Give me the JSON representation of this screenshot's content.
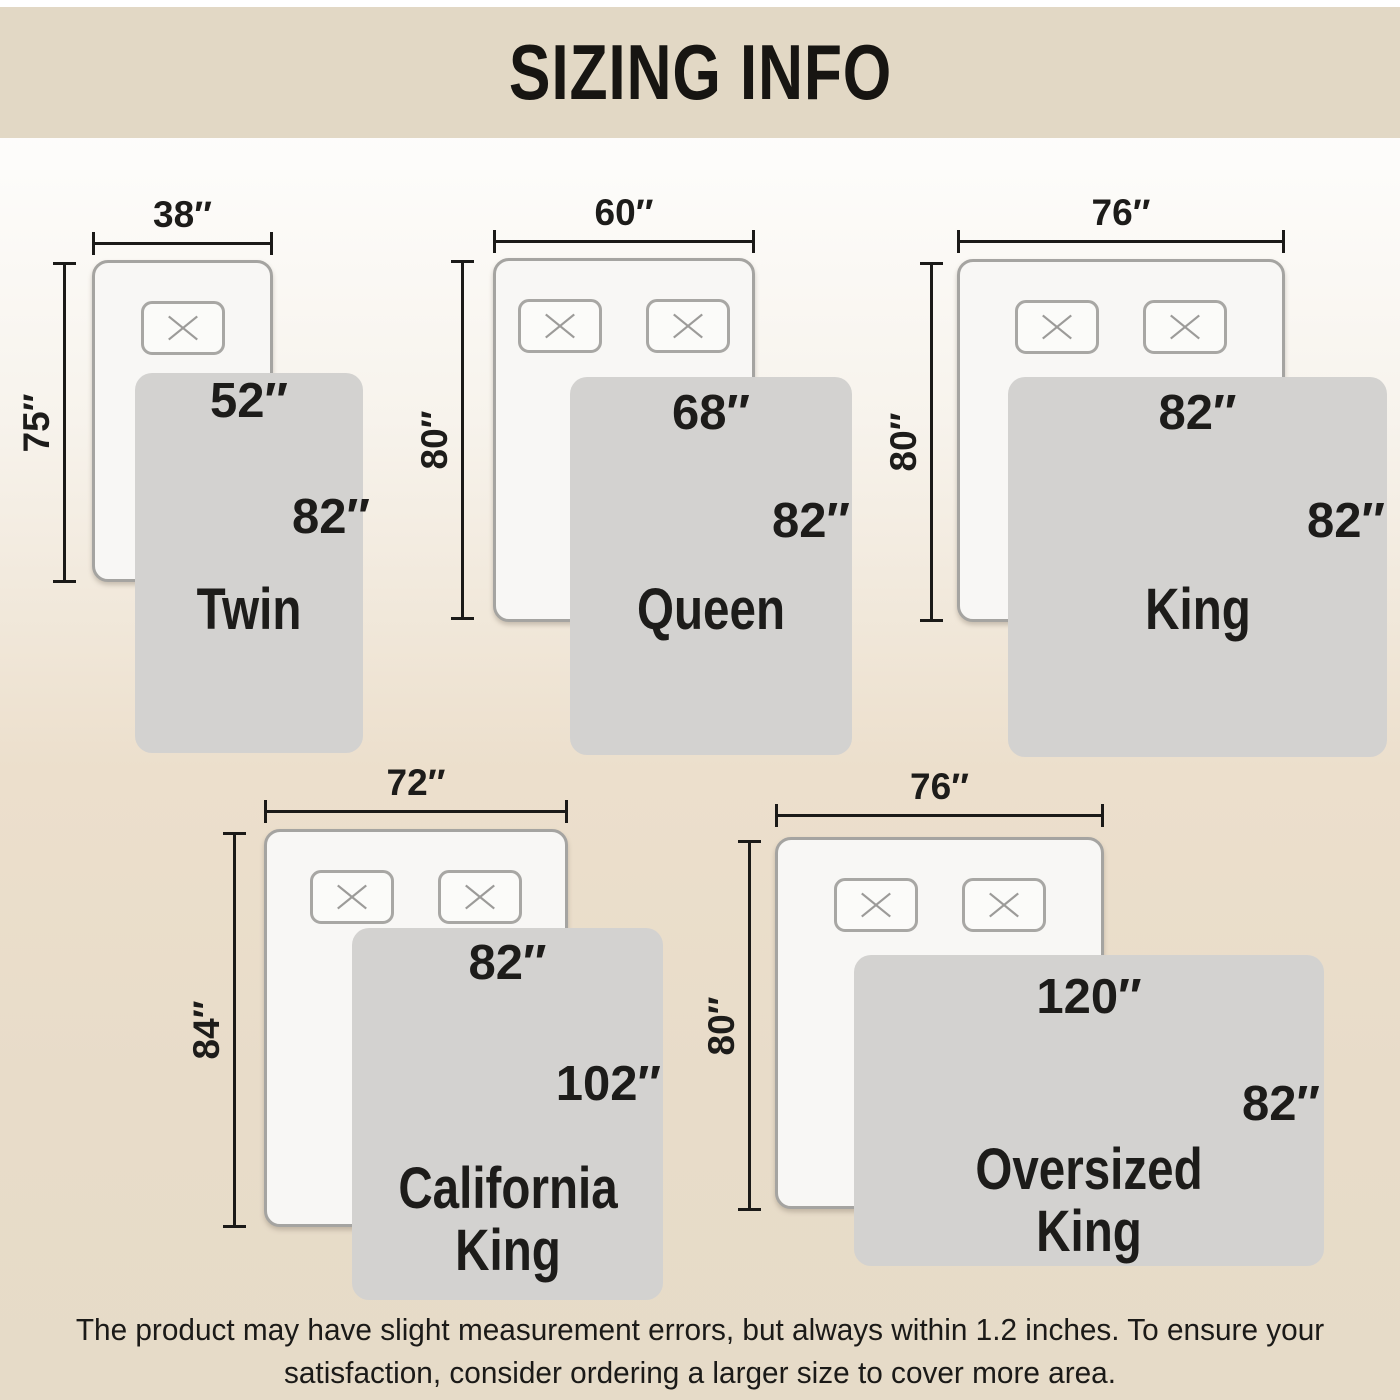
{
  "banner": {
    "title": "SIZING INFO"
  },
  "footer": {
    "lines": [
      "The product may have slight measurement errors, but always within 1.2 inches. To ensure your",
      "satisfaction, consider ordering a larger size to cover more area."
    ]
  },
  "colors": {
    "banner_bg": "#e2d8c5",
    "bg_top": "#ffffff",
    "bg_bottom": "#e6dbc8",
    "line": "#1b1a18",
    "mattress_fill": "#f8f7f5",
    "mattress_border": "#a5a4a1",
    "pillow_fill": "#fbfbf9",
    "pillow_border": "#a8a7a4",
    "pillow_x": "#9c9b99",
    "blanket_fill": "#d3d2d0",
    "text": "#1d1c1a"
  },
  "diagrams": [
    {
      "id": "twin",
      "name_lines": [
        "Twin"
      ],
      "mattress_width": "38″",
      "mattress_length": "75″",
      "blanket_width": "52″",
      "blanket_length": "82″",
      "pillows": 1,
      "geometry": {
        "mattress": {
          "x": 92,
          "y": 260,
          "w": 181,
          "h": 322
        },
        "dim_top_y": 242,
        "dim_left": {
          "x": 63,
          "y": 262,
          "h": 321
        },
        "blanket": {
          "x": 135,
          "y": 373,
          "w": 228,
          "h": 380
        },
        "w_label_top": 0,
        "h_label_pct": 38,
        "h_label_right": -7,
        "name_center_y": 237
      }
    },
    {
      "id": "queen",
      "name_lines": [
        "Queen"
      ],
      "mattress_width": "60″",
      "mattress_length": "80″",
      "blanket_width": "68″",
      "blanket_length": "82″",
      "pillows": 2,
      "geometry": {
        "mattress": {
          "x": 493,
          "y": 258,
          "w": 262,
          "h": 364
        },
        "dim_top_y": 240,
        "dim_left": {
          "x": 461,
          "y": 260,
          "h": 360
        },
        "blanket": {
          "x": 570,
          "y": 377,
          "w": 282,
          "h": 378
        },
        "w_label_top": 8,
        "h_label_pct": 38,
        "h_label_right": 2,
        "name_center_y": 233
      }
    },
    {
      "id": "king",
      "name_lines": [
        "King"
      ],
      "mattress_width": "76″",
      "mattress_length": "80″",
      "blanket_width": "82″",
      "blanket_length": "82″",
      "pillows": 2,
      "geometry": {
        "mattress": {
          "x": 957,
          "y": 259,
          "w": 328,
          "h": 363
        },
        "dim_top_y": 240,
        "dim_left": {
          "x": 930,
          "y": 262,
          "h": 360
        },
        "blanket": {
          "x": 1008,
          "y": 377,
          "w": 379,
          "h": 380
        },
        "w_label_top": 8,
        "h_label_pct": 38,
        "h_label_right": 2,
        "name_center_y": 233
      }
    },
    {
      "id": "california-king",
      "name_lines": [
        "California",
        "King"
      ],
      "mattress_width": "72″",
      "mattress_length": "84″",
      "blanket_width": "82″",
      "blanket_length": "102″",
      "pillows": 2,
      "geometry": {
        "mattress": {
          "x": 264,
          "y": 829,
          "w": 304,
          "h": 398
        },
        "dim_top_y": 810,
        "dim_left": {
          "x": 233,
          "y": 832,
          "h": 396
        },
        "blanket": {
          "x": 352,
          "y": 928,
          "w": 311,
          "h": 372
        },
        "w_label_top": 7,
        "h_label_pct": 42,
        "h_label_right": 2,
        "name_center_y": 292
      }
    },
    {
      "id": "oversized-king",
      "name_lines": [
        "Oversized",
        "King"
      ],
      "mattress_width": "76″",
      "mattress_length": "80″",
      "blanket_width": "120″",
      "blanket_length": "82″",
      "pillows": 2,
      "geometry": {
        "mattress": {
          "x": 775,
          "y": 837,
          "w": 329,
          "h": 372
        },
        "dim_top_y": 814,
        "dim_left": {
          "x": 748,
          "y": 840,
          "h": 371
        },
        "blanket": {
          "x": 854,
          "y": 955,
          "w": 470,
          "h": 311
        },
        "w_label_top": 14,
        "h_label_pct": 48,
        "h_label_right": 4,
        "name_center_y": 246
      }
    }
  ]
}
